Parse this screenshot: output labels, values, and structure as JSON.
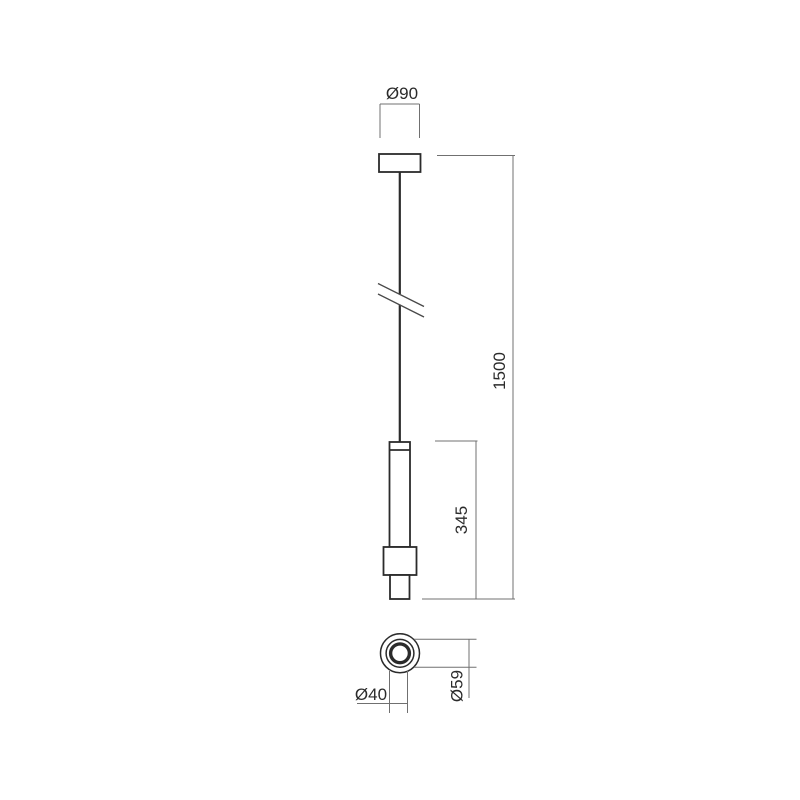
{
  "drawing": {
    "background": "#ffffff",
    "object_line_color": "#2b2b2b",
    "dimension_line_color": "#707070",
    "text_color": "#2b2b2b",
    "labels": {
      "canopy_diameter": "Ø90",
      "drop_length": "1500",
      "body_height": "345",
      "body_outer_diameter": "Ø59",
      "body_inner_diameter": "Ø40"
    }
  }
}
